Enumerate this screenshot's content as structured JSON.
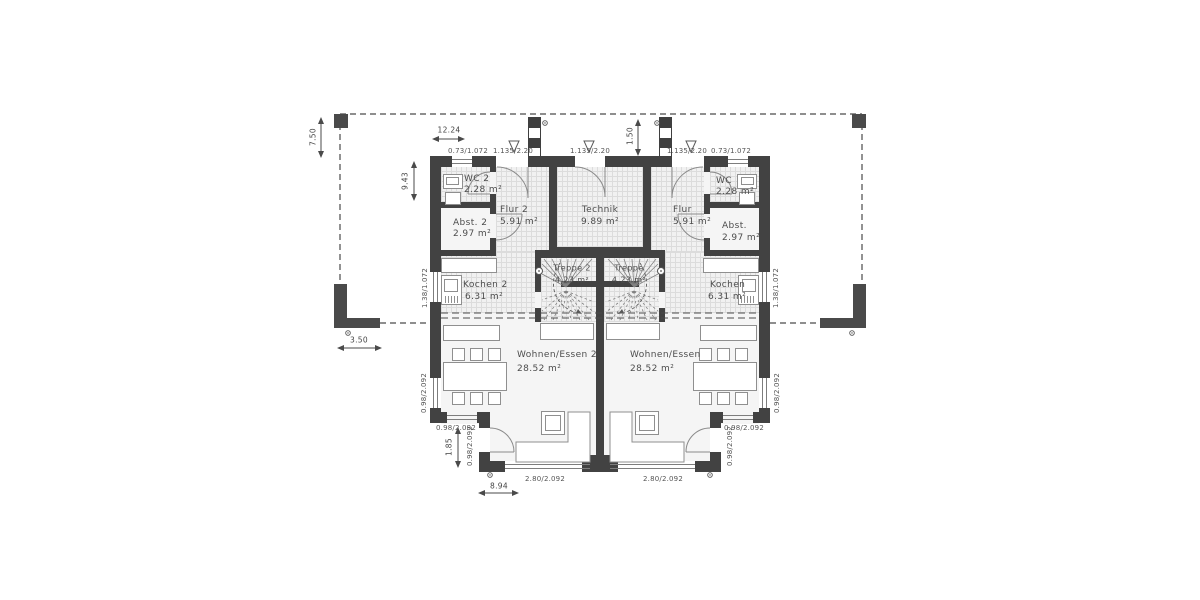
{
  "title": "Erdgeschoss Doppelhaus Grundriss",
  "colors": {
    "wall": "#424242",
    "floor": "#f5f5f5",
    "hatch_line": "#dcdcdc",
    "furniture_border": "#8f8f8f",
    "text": "#4a4a4a",
    "dash_line": "#4a4a4a"
  },
  "rooms": {
    "wc2": {
      "name": "WC 2",
      "area": "2.28 m²"
    },
    "abst2": {
      "name": "Abst. 2",
      "area": "2.97 m²"
    },
    "flur2": {
      "name": "Flur 2",
      "area": "5.91 m²"
    },
    "kochen2": {
      "name": "Kochen 2",
      "area": "6.31 m²"
    },
    "treppe2": {
      "name": "Treppe 2",
      "area": "4.23 m²"
    },
    "wohnen2": {
      "name": "Wohnen/Essen 2",
      "area": "28.52 m²"
    },
    "technik": {
      "name": "Technik",
      "area": "9.89 m²"
    },
    "wc": {
      "name": "WC",
      "area": "2.28 m²"
    },
    "abst": {
      "name": "Abst.",
      "area": "2.97 m²"
    },
    "flur": {
      "name": "Flur",
      "area": "5.91 m²"
    },
    "kochen": {
      "name": "Kochen",
      "area": "6.31 m²"
    },
    "treppe": {
      "name": "Treppe",
      "area": "4.23 m²"
    },
    "wohnen": {
      "name": "Wohnen/Essen",
      "area": "28.52 m²"
    }
  },
  "openings": {
    "wc_window": "0.73/1.072",
    "entrance_door": "1.135/2.20",
    "kitchen_window": "1.38/1.072",
    "west_window": "0.98/2.092",
    "south_window": "0.98/2.092",
    "side_door": "0.98/2.092",
    "terrace_window": "2.80/2.092"
  },
  "dimensions": {
    "overall_width": "12.24",
    "overall_depth": "9.43",
    "roof_overhang": "7.50",
    "terrace_wall": "3.50",
    "entry_recess": "1.50",
    "side_step": "1.85",
    "front_section": "8.94"
  }
}
